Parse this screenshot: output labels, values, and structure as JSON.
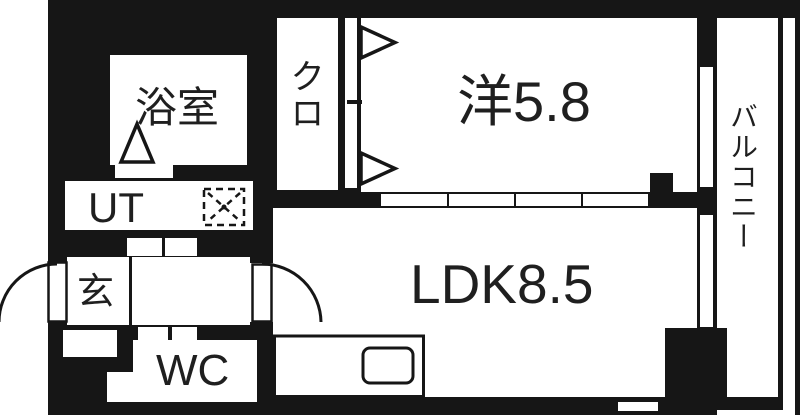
{
  "plan_title": "1LDK apartment floor plan",
  "rooms": {
    "bath": {
      "label": "浴室"
    },
    "closet": {
      "label": "クロ"
    },
    "western_room": {
      "label": "洋5.8",
      "size_tatami": "5.8"
    },
    "balcony": {
      "label": "バルコニー"
    },
    "utility": {
      "label": "UT"
    },
    "entrance": {
      "label": "玄"
    },
    "ldk": {
      "label": "LDK8.5",
      "size_tatami": "8.5"
    },
    "toilet": {
      "label": "WC"
    }
  },
  "colors": {
    "wall": "#161616",
    "floor": "#ffffff",
    "text": "#1f1f1f"
  }
}
